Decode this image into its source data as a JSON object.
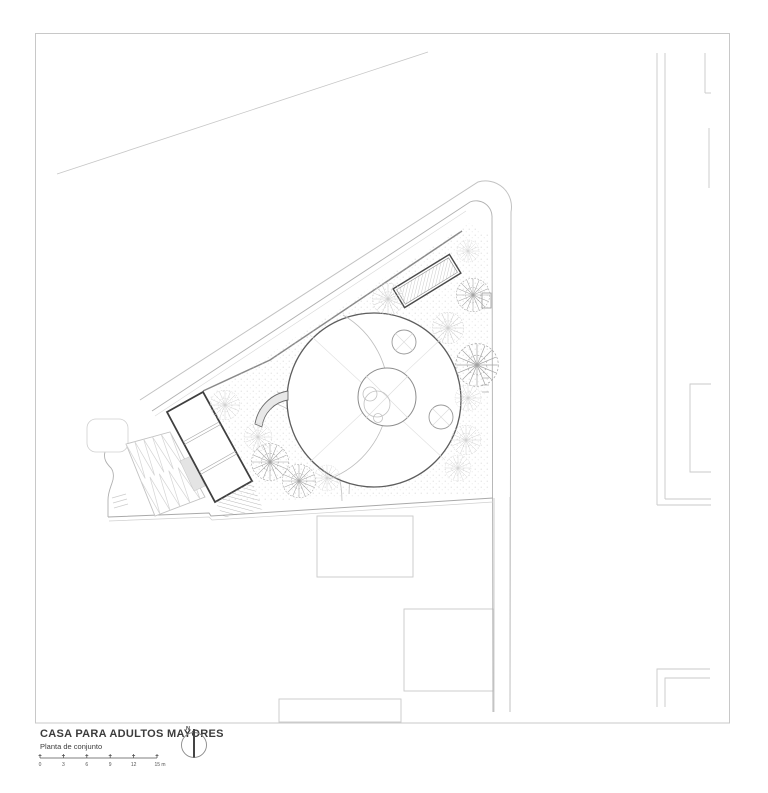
{
  "title_block": {
    "title": "CASA PARA ADULTOS MAYORES",
    "subtitle": "Planta de conjunto",
    "north_label": "N",
    "scale_labels": [
      "0",
      "3",
      "6",
      "9",
      "12",
      "15 m"
    ]
  },
  "colors": {
    "paper": "#ffffff",
    "sheet_frame": "#c8c8c8",
    "ink_dark": "#3f3f3f",
    "ink_medium": "#8a8a8a",
    "ink_light": "#c9c9c9",
    "shade_fill": "#e6e6e6"
  }
}
